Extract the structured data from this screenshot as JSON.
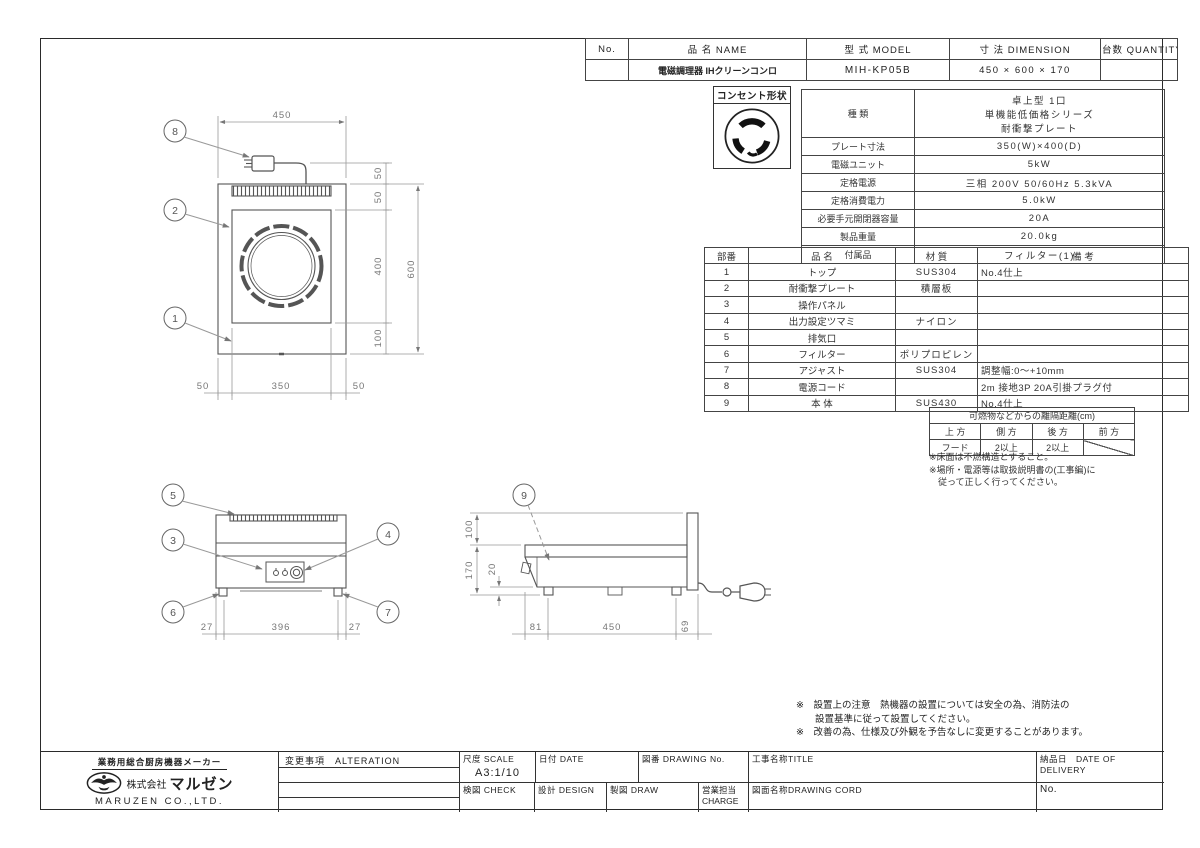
{
  "order_table": {
    "headers": [
      "No.",
      "品 名  NAME",
      "型 式  MODEL",
      "寸 法  DIMENSION",
      "台数 QUANTITY"
    ],
    "row": {
      "no": "",
      "name": "電磁調理器  IHクリーンコンロ",
      "model": "MIH-KP05B",
      "dimension": "450 × 600 × 170",
      "quantity": ""
    }
  },
  "outlet": {
    "label": "コンセント形状"
  },
  "spec": {
    "kind_label": "種  類",
    "kind_lines": [
      "卓上型 1口",
      "単機能低価格シリーズ",
      "耐衝撃プレート"
    ],
    "rows": [
      {
        "label": "プレート寸法",
        "value": "350(W)×400(D)"
      },
      {
        "label": "電磁ユニット",
        "value": "5kW"
      },
      {
        "label": "定格電源",
        "value": "三相 200V 50/60Hz 5.3kVA"
      },
      {
        "label": "定格消費電力",
        "value": "5.0kW"
      },
      {
        "label": "必要手元開閉器容量",
        "value": "20A"
      },
      {
        "label": "製品重量",
        "value": "20.0kg"
      },
      {
        "label": "付属品",
        "value": "フィルター(1)"
      }
    ]
  },
  "parts": {
    "headers": [
      "部番",
      "品  名",
      "材  質",
      "備  考"
    ],
    "rows": [
      {
        "no": "1",
        "name": "トップ",
        "material": "SUS304",
        "note": "No.4仕上"
      },
      {
        "no": "2",
        "name": "耐衝撃プレート",
        "material": "積層板",
        "note": ""
      },
      {
        "no": "3",
        "name": "操作パネル",
        "material": "",
        "note": ""
      },
      {
        "no": "4",
        "name": "出力設定ツマミ",
        "material": "ナイロン",
        "note": ""
      },
      {
        "no": "5",
        "name": "排気口",
        "material": "",
        "note": ""
      },
      {
        "no": "6",
        "name": "フィルター",
        "material": "ポリプロピレン",
        "note": ""
      },
      {
        "no": "7",
        "name": "アジャスト",
        "material": "SUS304",
        "note": "調整幅:0〜+10mm"
      },
      {
        "no": "8",
        "name": "電源コード",
        "material": "",
        "note": "2m 接地3P 20A引掛プラグ付"
      },
      {
        "no": "9",
        "name": "本  体",
        "material": "SUS430",
        "note": "No.4仕上"
      }
    ]
  },
  "clearance": {
    "title": "可燃物などからの離隔距離(cm)",
    "headers": [
      "上 方",
      "側 方",
      "後 方",
      "前 方"
    ],
    "values": [
      "フード",
      "2以上",
      "2以上",
      ""
    ],
    "notes": "※床面は不燃構造とすること。\n※場所・電源等は取扱説明書の(工事編)に\n　従って正しく行ってください。"
  },
  "bottom_notes": "※　設置上の注意　熱機器の設置については安全の為、消防法の\n　　設置基準に従って設置してください。\n※　改善の為、仕様及び外観を予告なしに変更することがあります。",
  "title_block": {
    "maker_tagline": "業務用総合厨房機器メーカー",
    "company_prefix": "株式会社",
    "company": "マルゼン",
    "company_en": "MARUZEN CO.,LTD.",
    "alteration_label": "変更事項　ALTERATION",
    "scale_label": "尺度 SCALE",
    "scale_value": "A3:1/10",
    "date_label": "日付 DATE",
    "drawing_no_label": "図番 DRAWING  No.",
    "title_label": "工事名称TITLE",
    "delivery_label": "納品日　DATE OF DELIVERY",
    "check_label": "検図 CHECK",
    "design_label": "設計 DESIGN",
    "draw_label": "製図 DRAW",
    "charge_label": "営業担当CHARGE",
    "drawing_cord_label": "図面名称DRAWING CORD",
    "no_label": "No."
  },
  "drawing": {
    "callouts": {
      "n1": "1",
      "n2": "2",
      "n3": "3",
      "n4": "4",
      "n5": "5",
      "n6": "6",
      "n7": "7",
      "n8": "8",
      "n9": "9"
    },
    "top_view": {
      "width": "450",
      "bottom": [
        "50",
        "350",
        "50"
      ],
      "right": [
        "50",
        "50",
        "400",
        "100"
      ],
      "depth": "600"
    },
    "front_view": {
      "bottom": [
        "27",
        "396",
        "27"
      ]
    },
    "side_view": {
      "heights": [
        "100",
        "170",
        "20"
      ],
      "bottom": [
        "81",
        "450",
        "69"
      ]
    }
  }
}
